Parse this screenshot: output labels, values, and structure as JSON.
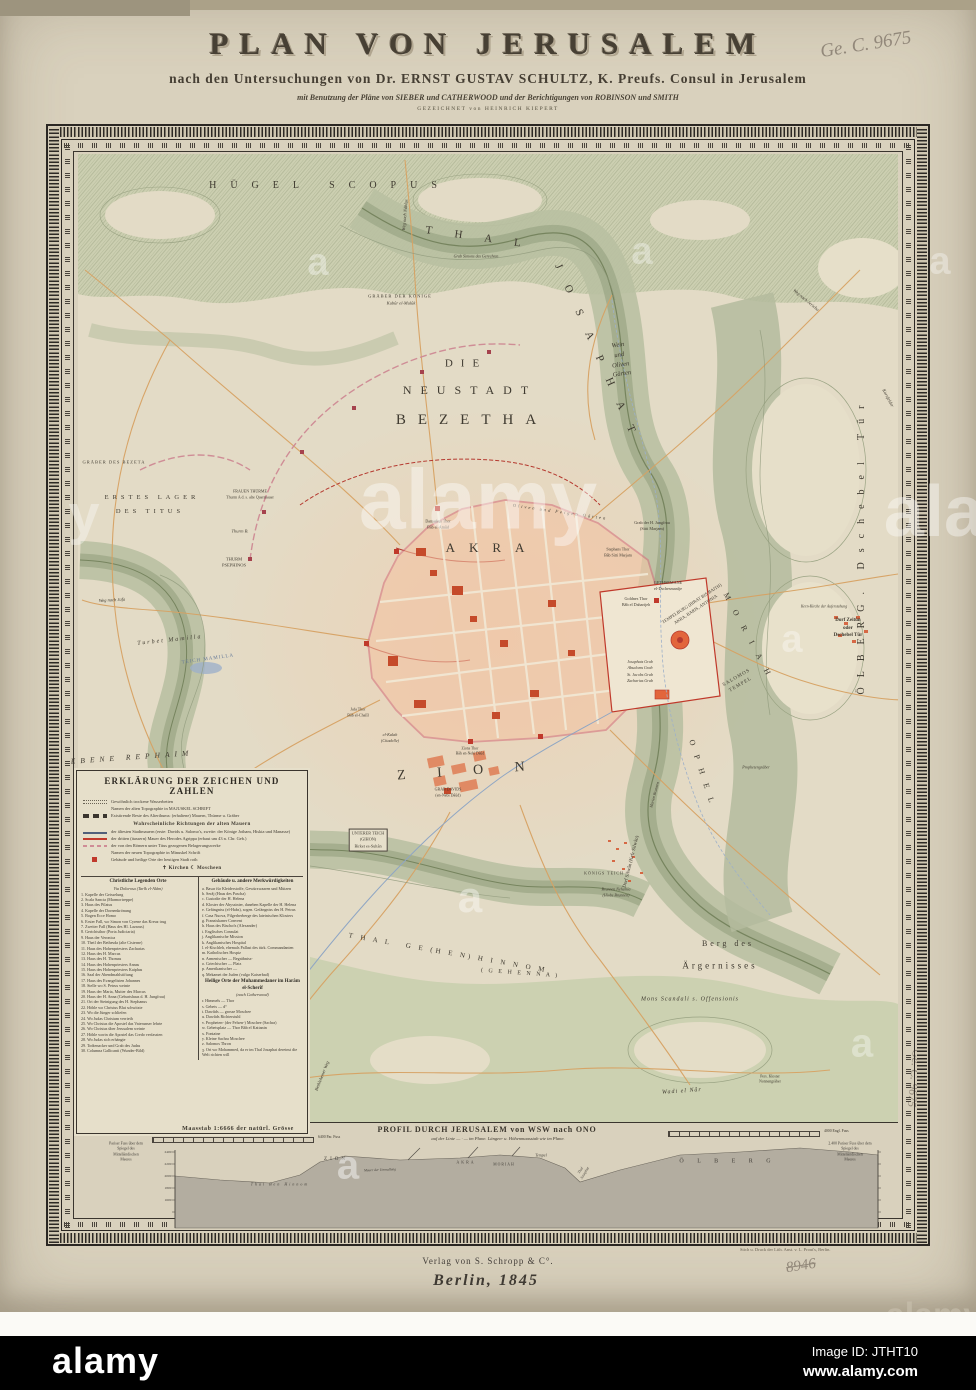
{
  "colors": {
    "paper": "#d9d1bd",
    "field": "#e3dbc6",
    "terrain": "#b9c0a2",
    "terrain_dark": "#8e987a",
    "city_fill": "#f2c4a4",
    "city_block": "#e79b74",
    "city_red": "#c0392b",
    "wall_pink": "#d5747e",
    "road_orange": "#d7a263",
    "water_blue": "#8fa6c4",
    "ink": "#3c372e",
    "frame": "#2b2723",
    "alamy_bar": "#000000"
  },
  "title": {
    "main": "PLAN VON JERUSALEM",
    "sub": "nach den Untersuchungen von Dr. ERNST GUSTAV SCHULTZ, K. Preufs. Consul in Jerusalem",
    "sub2": "mit Benutzung der Pläne von SIEBER und CATHERWOOD und der Berichtigungen von ROBINSON und SMITH",
    "sub3": "GEZEICHNET von HEINRICH KIEPERT"
  },
  "annotations": {
    "top_right": "Ge. C. 9675",
    "side_right": "Ge. C. 9675",
    "bottom_number": "8946"
  },
  "imprint": {
    "publisher": "Verlag von S. Schropp & C°.",
    "place_date": "Berlin, 1845",
    "printer": "Stich u. Druck der Lith. Anst. v. L. Prout's, Berlin."
  },
  "alamy_bar": {
    "logo": "alamy",
    "image_id": "Image ID: JTHT10",
    "website": "www.alamy.com"
  },
  "legend": {
    "header": "ERKLÄRUNG DER ZEICHEN UND ZAHLEN",
    "intro": [
      {
        "sw": "dry",
        "t": "Gewöhnlich trockene Wasserbetten"
      },
      {
        "sw": "none",
        "t": "Namen der alten Topographie in MAJUSKEL SCHRIFT"
      },
      {
        "sw": "ruin",
        "t": "Existirende Reste des Alterthums: (erhaltene) Mauern, Thürme u. Gräber"
      },
      {
        "sw": "head",
        "t": "Wahrscheinliche Richtungen der alten Mauern"
      },
      {
        "sw": "wall1",
        "t": "der ältesten Stadtmauern (erste: Davids u. Salomo's, zweite: der Könige Jotham, Hiskia und Manasse)"
      },
      {
        "sw": "wall3",
        "t": "der dritten (äussern) Mauer des Herodes Agrippa (erbaut um 43 n. Chr. Geb.)"
      },
      {
        "sw": "titus",
        "t": "der von den Römern unter Titus gezogenen Belagerungswerke"
      },
      {
        "sw": "none",
        "t": "Namen der neuen Topographie in Minuskel Schrift"
      },
      {
        "sw": "redsq",
        "t": "Gebäude und heilige Orte der heutigen Stadt roth"
      },
      {
        "sw": "sym",
        "t": "✝ Kirchen        ☾ Moscheen"
      }
    ],
    "left_header": "Christliche Legenden Orte",
    "left_subheader": "Via Dolorosa (Tarîk el-Alâm)",
    "left_items": [
      "1. Kapelle der Geisselung",
      "2. Scala Sancta (Marmortreppe)",
      "3. Haus des Pilatus",
      "4. Kapelle der Dornenkrönung",
      "5. Bogen Ecce Homo",
      "6. Erster Fall, wo Simon von Cyrene das Kreuz trug",
      "7. Zweiter Fall (Haus des Hl. Lazarus)",
      "8. Gerichtsthor (Porta Judiciaria)",
      "9. Haus der Veronica",
      "10. Theil der Bethesda (alte Cisterne)",
      "11. Haus des Hohenpriesters Zacharias",
      "12. Haus des H. Marcus",
      "13. Haus des H. Thomas",
      "14. Haus des Hohenpriesters Annas",
      "15. Haus des Hohenpriesters Kaiphas",
      "16. Saal der Abendmahlstiftung",
      "17. Haus des Evangelisten Johannes",
      "18. Stelle wo S. Petrus weinte",
      "19. Haus der Maria, Mutter des Marcus",
      "20. Haus der H. Anna (Geburtshaus d. H. Jungfrau)",
      "21. Ort der Steinigung des H. Stephanus",
      "22. Höhle wo Christus Blut schwitzte",
      "23. Wo die Jünger schliefen",
      "24. Wo Judas Christum verrieth",
      "25. Wo Christus die Apostel das Vaterunser lehrte",
      "26. Wo Christus über Jerusalem weinte",
      "27. Höhle worin die Apostel das Credo verfassten",
      "28. Wo Judas sich erhängte",
      "29. Todtenacker und Grab des Judas",
      "30. Columna Gallicanti (Wunder-Bild)"
    ],
    "right_header": "Gebäude u. andere Merkwürdigkeiten",
    "right_items": [
      "a. Basar für Kleiderstoffe, Gewürzwaaren und Mützen",
      "b. Serâj (Haus des Pascha)",
      "c. Custodie der H. Helena",
      "d. Kloster der Abyssinier, daneben Kapelle der H. Helena",
      "e. Gefängniss (el-Habs), sogen. Gefängniss des H. Petrus",
      "f. Casa Nuova, Pilgerherberge des lateinischen Klosters",
      "g. Franziskaner Convent",
      "h. Haus des Bischofs (Alexander)",
      "i. Englisches Consulat",
      "j. Anglikanische Mission",
      "k. Anglikanisches Hospital",
      "l. el-Kischleh, ehemals Pallast des türk. Commandanten",
      "m. Katholisches Hospiz",
      "n. Armenischer  —  Begräbniss-",
      "o. Griechischer  —  Platz",
      "p. Amerikanischer  —",
      "q. Mekamet der Juden (vulgo Kaiserbad)"
    ],
    "haram_header": "Heilige Orte der Muhammedaner im Harâm el-Scherîf",
    "haram_subheader": "(nach Catherwood)",
    "haram_items": [
      "r. Himmels  —  Thor",
      "s. Gebets  —  d°",
      "t. Dawûds  —  grosse Moschee",
      "u. Dawûds Richterstuhl",
      "v. Propheten- (der Felsen-) Moschee (Sachra)",
      "w. Gebetsplatz  —  Thor Bâb el Kattanin",
      "x. Fontaine",
      "y. Kleine Sachra Moschee",
      "z. Salomos Thron",
      "ʒ. Ort wo Mohammed, da er im Thal Josaphat dereinst die Welt richten will"
    ]
  },
  "map_labels": [
    {
      "t": "HÜGEL SCOPUS",
      "x": 330,
      "y": 186,
      "s": 10,
      "ls": 14
    },
    {
      "t": "T H A L",
      "x": 478,
      "y": 238,
      "s": 11,
      "ls": 10,
      "r": 8
    },
    {
      "t": "J O S A P H A T",
      "x": 596,
      "y": 352,
      "s": 11,
      "ls": 8,
      "r": 66
    },
    {
      "t": "DIE",
      "x": 466,
      "y": 364,
      "s": 11,
      "ls": 8
    },
    {
      "t": "NEUSTADT",
      "x": 470,
      "y": 390,
      "s": 12,
      "ls": 9
    },
    {
      "t": "BEZETHA",
      "x": 472,
      "y": 420,
      "s": 15,
      "ls": 12
    },
    {
      "t": "Wein\nund\nOliven\nGärten",
      "x": 620,
      "y": 360,
      "s": 6.5,
      "i": 1,
      "r": -8,
      "lh": 1.5
    },
    {
      "t": "GRÄBER DER KÖNIGE",
      "x": 400,
      "y": 296,
      "s": 4.5,
      "ls": 1
    },
    {
      "t": "Kubûr el-Mulûk",
      "x": 401,
      "y": 303,
      "s": 4.5,
      "i": 1
    },
    {
      "t": "Grab Simons des Gerechten",
      "x": 476,
      "y": 257,
      "s": 4,
      "i": 1
    },
    {
      "t": "Weg nach Nâblus",
      "x": 405,
      "y": 215,
      "s": 4.5,
      "i": 1,
      "r": -85
    },
    {
      "t": "Weg nach Jericho",
      "x": 806,
      "y": 300,
      "s": 4.5,
      "i": 1,
      "r": 40
    },
    {
      "t": "Kornfelder",
      "x": 888,
      "y": 398,
      "s": 4.5,
      "i": 1,
      "r": 62
    },
    {
      "t": "ERSTES LAGER",
      "x": 152,
      "y": 498,
      "s": 6.5,
      "ls": 4
    },
    {
      "t": "DES TITUS",
      "x": 150,
      "y": 512,
      "s": 6.5,
      "ls": 4
    },
    {
      "t": "GRÄBER DES BEZETA",
      "x": 114,
      "y": 462,
      "s": 4.5,
      "ls": 1
    },
    {
      "t": "THURM\nPSEPHINOS",
      "x": 234,
      "y": 563,
      "s": 4.5,
      "lh": 1.4
    },
    {
      "t": "FRAUEN THÜRME\nThurm A d. s. alte Quermauer",
      "x": 250,
      "y": 494,
      "s": 4,
      "lh": 1.4
    },
    {
      "t": "Thurm B.",
      "x": 240,
      "y": 531,
      "s": 4.5,
      "i": 1
    },
    {
      "t": "Weg nach Jafa",
      "x": 112,
      "y": 600,
      "s": 4.5,
      "i": 1,
      "r": -3
    },
    {
      "t": "Turbet Mamilla",
      "x": 170,
      "y": 641,
      "s": 6,
      "i": 1,
      "r": -6,
      "ls": 2
    },
    {
      "t": "TEICH MAMILLA",
      "x": 208,
      "y": 660,
      "s": 5,
      "r": -8,
      "c": "#667a99",
      "ls": 1
    },
    {
      "t": "EBENE REPHAIM",
      "x": 132,
      "y": 757,
      "s": 7.5,
      "i": 1,
      "ls": 5,
      "r": -4
    },
    {
      "t": "AKRA",
      "x": 492,
      "y": 548,
      "s": 13,
      "ls": 14
    },
    {
      "t": "Oliven und Feigen Gärten",
      "x": 560,
      "y": 512,
      "s": 4.5,
      "i": 1,
      "r": 8,
      "ls": 2
    },
    {
      "t": "Damaskus Thor\nBâb el-Amûd",
      "x": 438,
      "y": 524,
      "s": 4,
      "lh": 1.4
    },
    {
      "t": "Stephans Thor\nBâb Sitti Marjam",
      "x": 618,
      "y": 552,
      "s": 4,
      "lh": 1.4
    },
    {
      "t": "TEMPELBURG (BIRAT BIS BAITH)\nAKRA, BARIS, ANTONIA",
      "x": 694,
      "y": 607,
      "s": 4.5,
      "r": -33,
      "lh": 1.5
    },
    {
      "t": "M O R I A H",
      "x": 748,
      "y": 636,
      "s": 8,
      "ls": 5,
      "r": 62
    },
    {
      "t": "SALOMOS\nTEMPEL",
      "x": 739,
      "y": 682,
      "s": 5,
      "r": -30,
      "lh": 1.6,
      "ls": 1
    },
    {
      "t": "Goldnes Thor\nBâb el Daharijeh",
      "x": 636,
      "y": 602,
      "s": 4.2,
      "lh": 1.4
    },
    {
      "t": "GETHSEMANE\nel-Dschesmanîje",
      "x": 668,
      "y": 586,
      "s": 4.2,
      "lh": 1.4
    },
    {
      "t": "Grab der H. Jungfrau\n(Sitti Marjam)",
      "x": 652,
      "y": 526,
      "s": 4.2,
      "lh": 1.4
    },
    {
      "t": "Josaphats Grab\nAbsaloms Grab\nSt. Jacobs Grab\nZacharias Grab",
      "x": 640,
      "y": 672,
      "s": 4,
      "lh": 1.6,
      "i": 1
    },
    {
      "t": "Prophetengräber",
      "x": 756,
      "y": 768,
      "s": 4,
      "i": 1
    },
    {
      "t": "Marien Brunnen",
      "x": 655,
      "y": 795,
      "s": 4,
      "i": 1,
      "r": -75
    },
    {
      "t": "Z I O N",
      "x": 468,
      "y": 772,
      "s": 14,
      "ls": 14,
      "r": -4
    },
    {
      "t": "O P H E L",
      "x": 702,
      "y": 773,
      "s": 8,
      "ls": 4,
      "r": 72
    },
    {
      "t": "el-Kalah\n(Citadelle)",
      "x": 390,
      "y": 738,
      "s": 4.2,
      "lh": 1.4,
      "i": 1
    },
    {
      "t": "Jafa Thor\nBâb el-Chalîl",
      "x": 358,
      "y": 712,
      "s": 4,
      "lh": 1.4
    },
    {
      "t": "Zions Thor\nBâb en-Nebi Dâûd",
      "x": 470,
      "y": 752,
      "s": 3.8,
      "lh": 1.4
    },
    {
      "t": "GRAB DAVIDS\n(en-Nebi Dâûd)",
      "x": 448,
      "y": 792,
      "s": 4,
      "lh": 1.4
    },
    {
      "t": "UNTERER TEICH\n(GIHON)\nBirket es-Sultân",
      "x": 368,
      "y": 840,
      "s": 4.2,
      "lh": 1.5,
      "box": 1
    },
    {
      "t": "KÖNIGS TEICH",
      "x": 604,
      "y": 874,
      "s": 4,
      "ls": 1
    },
    {
      "t": "Brunnen Nehemia\n(Hiobs Brunnen)",
      "x": 616,
      "y": 892,
      "s": 4,
      "lh": 1.4,
      "i": 1
    },
    {
      "t": "Dorf Silwân (Kefr Silwân)",
      "x": 632,
      "y": 862,
      "s": 5,
      "r": -76
    },
    {
      "t": "T H A L   G E (H E N) H I N N O M",
      "x": 448,
      "y": 953,
      "s": 7,
      "ls": 3,
      "r": 10
    },
    {
      "t": "( G E H E N N A )",
      "x": 520,
      "y": 974,
      "s": 6,
      "ls": 2,
      "r": 4
    },
    {
      "t": "Berg des",
      "x": 728,
      "y": 944,
      "s": 8,
      "ls": 3
    },
    {
      "t": "Ärgernisses",
      "x": 720,
      "y": 966,
      "s": 9,
      "ls": 3
    },
    {
      "t": "Mons Scandali s. Offensionis",
      "x": 690,
      "y": 1000,
      "s": 6,
      "ls": 1,
      "i": 1
    },
    {
      "t": "Wadi el Nâr",
      "x": 682,
      "y": 1092,
      "s": 6,
      "i": 1,
      "r": -4,
      "ls": 1
    },
    {
      "t": "Bethlehemer Weg",
      "x": 322,
      "y": 1076,
      "s": 4.5,
      "i": 1,
      "r": -68
    },
    {
      "t": "Pers. Kloster\nNonnengräber",
      "x": 770,
      "y": 1080,
      "s": 3.8,
      "lh": 1.4
    },
    {
      "t": "ÖLBERG. Dschebel Tûr",
      "x": 862,
      "y": 545,
      "s": 10,
      "ls": 10,
      "r": -90
    },
    {
      "t": "Kern-Kirche der Auferstehung",
      "x": 824,
      "y": 607,
      "s": 3.8,
      "i": 1
    },
    {
      "t": "Dorf Zeitûn\noder\nDschebel Tûr",
      "x": 848,
      "y": 628,
      "s": 5,
      "lh": 1.5,
      "w": 700
    }
  ],
  "profile": {
    "scale_label": "Maasstab 1:6666 der natürl. Grösse",
    "title": "PROFIL DURCH JERUSALEM von WSW nach ONO",
    "subtitle": "auf der Linie — · — im Plane.  Längen- u. Höhenmaasstab wie im Plane.",
    "ruler1_label": "6400 Par. Fuss",
    "ruler2_label": "4000 Engl. Fuss",
    "labels": [
      {
        "t": "Pariser Fuss über dem\nSpiegel des\nMittelländischen\nMeeres",
        "x": 48,
        "y": 30,
        "s": 3.8,
        "lh": 1.4
      },
      {
        "t": "2.400 Pariser Fuss über dem\nSpiegel des\nMittelländischen\nMeeres",
        "x": 772,
        "y": 30,
        "s": 3.8,
        "lh": 1.4
      },
      {
        "t": "2400",
        "x": 90,
        "y": 30,
        "s": 3.5
      },
      {
        "t": "2200",
        "x": 90,
        "y": 42,
        "s": 3.5
      },
      {
        "t": "2000",
        "x": 90,
        "y": 54,
        "s": 3.5
      },
      {
        "t": "1800",
        "x": 90,
        "y": 66,
        "s": 3.5
      },
      {
        "t": "1600",
        "x": 90,
        "y": 78,
        "s": 3.5
      },
      {
        "t": "ZION",
        "x": 258,
        "y": 38,
        "s": 5,
        "ls": 3
      },
      {
        "t": "AKRA",
        "x": 388,
        "y": 40,
        "s": 4,
        "ls": 2
      },
      {
        "t": "MORIAH",
        "x": 426,
        "y": 43,
        "s": 3.8,
        "ls": 1
      },
      {
        "t": "Tempel",
        "x": 463,
        "y": 33,
        "s": 4,
        "i": 1
      },
      {
        "t": "Thal Ben Hinnom",
        "x": 202,
        "y": 62,
        "s": 4,
        "i": 1,
        "ls": 2
      },
      {
        "t": "Mauer der Umwallung",
        "x": 302,
        "y": 48,
        "s": 3.5,
        "i": 1,
        "r": -2
      },
      {
        "t": "Thal\nJosaphat",
        "x": 505,
        "y": 50,
        "s": 3.8,
        "i": 1,
        "r": -58,
        "lh": 1.3
      },
      {
        "t": "Ö L B E R G",
        "x": 650,
        "y": 40,
        "s": 6,
        "ls": 6
      }
    ]
  },
  "watermarks": [
    {
      "t": "alamy",
      "x": 478,
      "y": 500,
      "s": 84,
      "o": 0.42
    },
    {
      "t": "alamy",
      "x": 986,
      "y": 512,
      "s": 72,
      "o": 0.4
    },
    {
      "t": "a",
      "x": 318,
      "y": 263,
      "s": 38,
      "o": 0.38
    },
    {
      "t": "a",
      "x": 642,
      "y": 252,
      "s": 38,
      "o": 0.35
    },
    {
      "t": "a",
      "x": 940,
      "y": 262,
      "s": 38,
      "o": 0.35
    },
    {
      "t": "y",
      "x": 84,
      "y": 514,
      "s": 56,
      "o": 0.35
    },
    {
      "t": "a",
      "x": 792,
      "y": 640,
      "s": 38,
      "o": 0.35
    },
    {
      "t": "a",
      "x": 470,
      "y": 898,
      "s": 44,
      "o": 0.4
    },
    {
      "t": "a",
      "x": 348,
      "y": 1166,
      "s": 40,
      "o": 0.45
    },
    {
      "t": "a",
      "x": 862,
      "y": 1044,
      "s": 40,
      "o": 0.35
    },
    {
      "t": "alamy",
      "x": 934,
      "y": 1316,
      "s": 34,
      "o": 0.55,
      "c": "#cdc5b3"
    }
  ]
}
